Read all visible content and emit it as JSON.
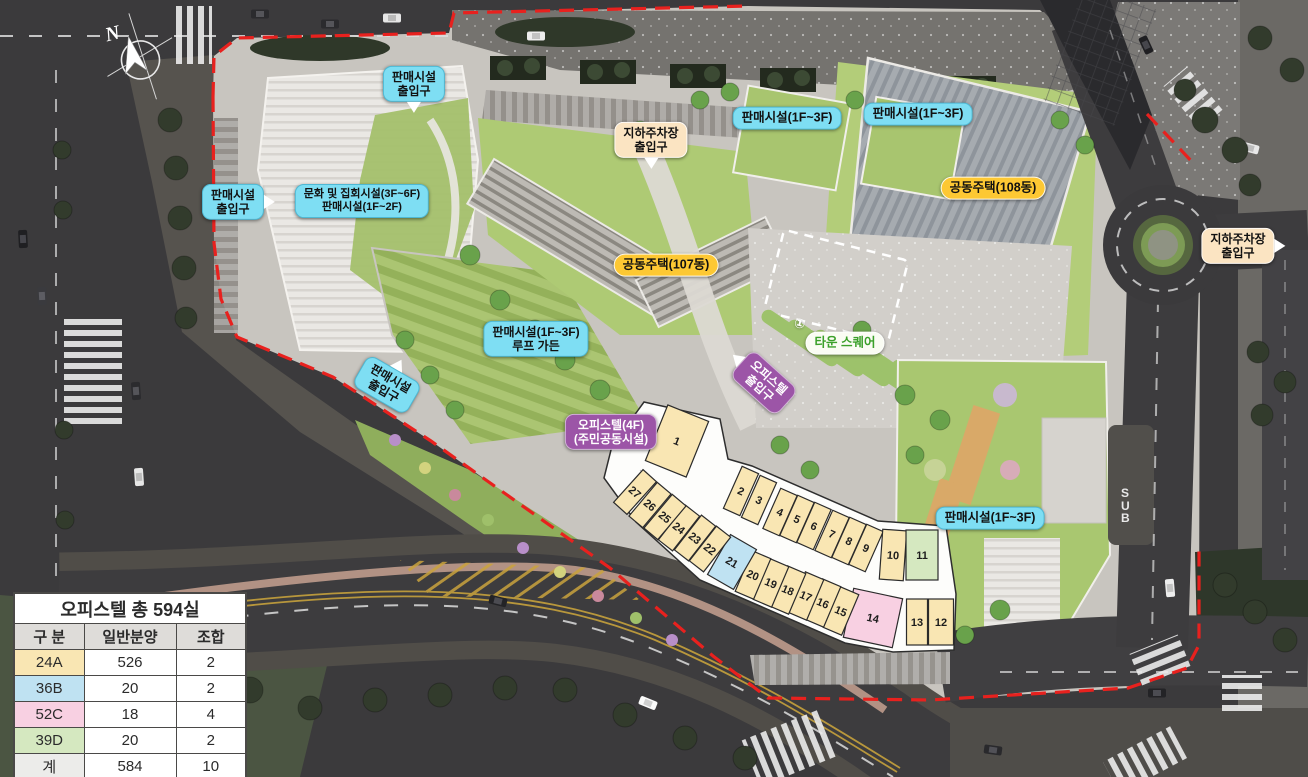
{
  "legend_table": {
    "title": "오피스텔 총 594실",
    "headers": [
      "구 분",
      "일반분양",
      "조합"
    ],
    "rows": [
      {
        "label": "24A",
        "general": "526",
        "assoc": "2",
        "color": "#f9e6b3"
      },
      {
        "label": "36B",
        "general": "20",
        "assoc": "2",
        "color": "#bfe2f2"
      },
      {
        "label": "52C",
        "general": "18",
        "assoc": "4",
        "color": "#f8d0e2"
      },
      {
        "label": "39D",
        "general": "20",
        "assoc": "2",
        "color": "#d5e8c0"
      },
      {
        "label": "계",
        "general": "584",
        "assoc": "10",
        "color": "#ececea"
      }
    ]
  },
  "map_labels": [
    {
      "id": "entrance-retail-top",
      "text": [
        "판매시설",
        "출입구"
      ],
      "style": "cyan",
      "x": 414,
      "y": 84,
      "arrow": "down"
    },
    {
      "id": "entrance-parking-top",
      "text": [
        "지하주차장",
        "출입구"
      ],
      "style": "peach",
      "x": 651,
      "y": 140,
      "arrow": "down"
    },
    {
      "id": "retail-1f3f-a",
      "text": [
        "판매시설(1F~3F)"
      ],
      "style": "cyan",
      "x": 787,
      "y": 118
    },
    {
      "id": "retail-1f3f-b",
      "text": [
        "판매시설(1F~3F)"
      ],
      "style": "cyan",
      "x": 918,
      "y": 114
    },
    {
      "id": "apt-108",
      "text": [
        "공동주택(108동)"
      ],
      "style": "yellow",
      "x": 993,
      "y": 188
    },
    {
      "id": "entrance-parking-right",
      "text": [
        "지하주차장",
        "출입구"
      ],
      "style": "peach",
      "x": 1238,
      "y": 246,
      "arrow": "right"
    },
    {
      "id": "entrance-retail-left",
      "text": [
        "판매시설",
        "출입구"
      ],
      "style": "cyan",
      "x": 233,
      "y": 202,
      "arrow": "right"
    },
    {
      "id": "culture-retail",
      "text": [
        "문화 및 집회시설(3F~6F)",
        "판매시설(1F~2F)"
      ],
      "style": "cyan",
      "x": 362,
      "y": 201
    },
    {
      "id": "apt-107",
      "text": [
        "공동주택(107동)"
      ],
      "style": "yellow",
      "x": 666,
      "y": 265
    },
    {
      "id": "retail-roof-garden",
      "text": [
        "판매시설(1F~3F)",
        "루프 가든"
      ],
      "style": "cyan",
      "x": 536,
      "y": 339
    },
    {
      "id": "town-square",
      "text": [
        "타운 스퀘어"
      ],
      "style": "green-pill",
      "x": 845,
      "y": 343
    },
    {
      "id": "entrance-retail-bottom",
      "text": [
        "판매시설",
        "출입구"
      ],
      "style": "cyan",
      "x": 387,
      "y": 385,
      "rotate": 30,
      "arrow": "up"
    },
    {
      "id": "entrance-officetel",
      "text": [
        "오피스텔",
        "출입구"
      ],
      "style": "purple",
      "x": 764,
      "y": 383,
      "rotate": 42,
      "arrow": "left"
    },
    {
      "id": "officetel-4f",
      "text": [
        "오피스텔(4F)",
        "(주민공동시설)"
      ],
      "style": "purple",
      "x": 611,
      "y": 432
    },
    {
      "id": "retail-1f3f-c",
      "text": [
        "판매시설(1F~3F)"
      ],
      "style": "cyan",
      "x": 990,
      "y": 518
    }
  ],
  "unit_colors": {
    "24A": "#f9e6b3",
    "36B": "#bfe2f2",
    "52C": "#f8d0e2",
    "39D": "#d5e8c0"
  },
  "units": [
    {
      "no": "1",
      "x": 677,
      "y": 441,
      "w": 44,
      "h": 60,
      "r": 22,
      "type": "24A"
    },
    {
      "no": "2",
      "x": 741,
      "y": 491,
      "w": 18,
      "h": 46,
      "r": 24,
      "type": "24A"
    },
    {
      "no": "3",
      "x": 759,
      "y": 500,
      "w": 18,
      "h": 46,
      "r": 24,
      "type": "24A"
    },
    {
      "no": "4",
      "x": 780,
      "y": 512,
      "w": 18,
      "h": 44,
      "r": 24,
      "type": "24A"
    },
    {
      "no": "5",
      "x": 797,
      "y": 519,
      "w": 18,
      "h": 44,
      "r": 24,
      "type": "24A"
    },
    {
      "no": "6",
      "x": 814,
      "y": 526,
      "w": 18,
      "h": 44,
      "r": 24,
      "type": "24A"
    },
    {
      "no": "7",
      "x": 832,
      "y": 534,
      "w": 18,
      "h": 44,
      "r": 24,
      "type": "24A"
    },
    {
      "no": "8",
      "x": 849,
      "y": 541,
      "w": 18,
      "h": 44,
      "r": 24,
      "type": "24A"
    },
    {
      "no": "9",
      "x": 866,
      "y": 548,
      "w": 18,
      "h": 44,
      "r": 24,
      "type": "24A"
    },
    {
      "no": "10",
      "x": 893,
      "y": 555,
      "w": 24,
      "h": 50,
      "r": 4,
      "type": "24A"
    },
    {
      "no": "11",
      "x": 922,
      "y": 555,
      "w": 32,
      "h": 50,
      "r": 0,
      "type": "39D"
    },
    {
      "no": "12",
      "x": 941,
      "y": 622,
      "w": 25,
      "h": 46,
      "r": 0,
      "type": "24A"
    },
    {
      "no": "13",
      "x": 917,
      "y": 622,
      "w": 21,
      "h": 46,
      "r": 0,
      "type": "24A"
    },
    {
      "no": "14",
      "x": 873,
      "y": 618,
      "w": 50,
      "h": 50,
      "r": 12,
      "type": "52C"
    },
    {
      "no": "15",
      "x": 841,
      "y": 611,
      "w": 20,
      "h": 44,
      "r": 23,
      "type": "24A"
    },
    {
      "no": "16",
      "x": 823,
      "y": 603,
      "w": 20,
      "h": 44,
      "r": 23,
      "type": "24A"
    },
    {
      "no": "17",
      "x": 806,
      "y": 596,
      "w": 20,
      "h": 44,
      "r": 23,
      "type": "24A"
    },
    {
      "no": "18",
      "x": 788,
      "y": 590,
      "w": 20,
      "h": 44,
      "r": 23,
      "type": "24A"
    },
    {
      "no": "19",
      "x": 771,
      "y": 583,
      "w": 20,
      "h": 44,
      "r": 23,
      "type": "24A"
    },
    {
      "no": "20",
      "x": 753,
      "y": 575,
      "w": 20,
      "h": 44,
      "r": 23,
      "type": "24A"
    },
    {
      "no": "21",
      "x": 732,
      "y": 562,
      "w": 30,
      "h": 46,
      "r": 30,
      "type": "36B"
    },
    {
      "no": "22",
      "x": 710,
      "y": 549,
      "w": 18,
      "h": 44,
      "r": 38,
      "type": "24A"
    },
    {
      "no": "23",
      "x": 695,
      "y": 538,
      "w": 18,
      "h": 44,
      "r": 38,
      "type": "24A"
    },
    {
      "no": "24",
      "x": 679,
      "y": 528,
      "w": 18,
      "h": 44,
      "r": 38,
      "type": "24A"
    },
    {
      "no": "25",
      "x": 665,
      "y": 517,
      "w": 18,
      "h": 44,
      "r": 40,
      "type": "24A"
    },
    {
      "no": "26",
      "x": 650,
      "y": 505,
      "w": 18,
      "h": 44,
      "r": 40,
      "type": "24A"
    },
    {
      "no": "27",
      "x": 635,
      "y": 492,
      "w": 18,
      "h": 44,
      "r": 42,
      "type": "24A"
    }
  ],
  "compass": {
    "label": "N"
  },
  "road": {
    "bus_label": "BUS"
  },
  "plaza": {
    "parking_mark": "①"
  }
}
